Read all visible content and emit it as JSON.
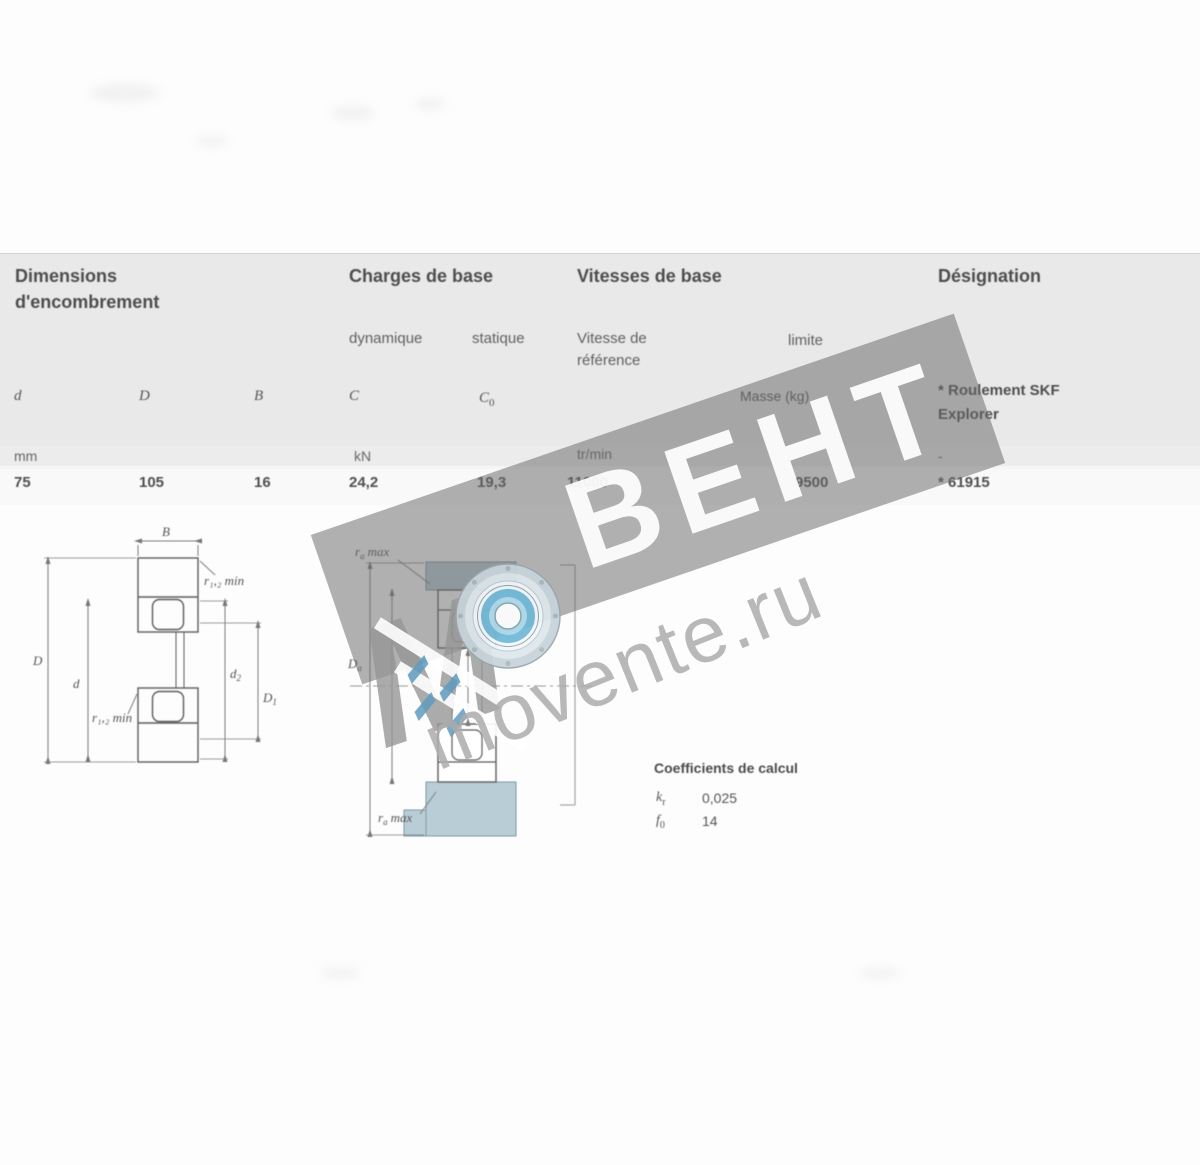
{
  "table": {
    "group1_line1": "Dimensions",
    "group1_line2": "d'encombrement",
    "group2": "Charges de base",
    "group3": "Vitesses de base",
    "group4": "Désignation",
    "sub_dyn": "dynamique",
    "sub_stat": "statique",
    "sub_ref1": "Vitesse de",
    "sub_ref2": "référence",
    "sub_lim": "limite",
    "sym_d": "d",
    "sym_D": "D",
    "sym_B": "B",
    "sym_C": "C",
    "sym_C0_base": "C",
    "sym_C0_sub": "0",
    "sym_mass": "Masse (kg)",
    "note_line1": "* Roulement SKF",
    "note_line2": "Explorer",
    "unit_dim": "mm",
    "unit_load": "kN",
    "unit_speed": "tr/min",
    "unit_desig": "-",
    "val_d": "75",
    "val_D": "105",
    "val_B": "16",
    "val_C": "24,2",
    "val_C0": "19,3",
    "val_vref": "11000",
    "val_vlim": "9500",
    "val_desig": "* 61915"
  },
  "drawings": {
    "left": {
      "B": "B",
      "r12_top": "r₁,₂ min",
      "r12_bottom": "r₁,₂ min",
      "D": "D",
      "d": "d",
      "d2_base": "d",
      "d2_sub": "2",
      "D1_base": "D",
      "D1_sub": "1"
    },
    "middle": {
      "ra_top_base": "r",
      "ra_top_sub": "a",
      "ra_top_suffix": "max",
      "ra_bot_base": "r",
      "ra_bot_sub": "a",
      "ra_bot_suffix": "max",
      "Da_base": "D",
      "Da_sub": "a",
      "da_base": "d",
      "da_sub": "a"
    },
    "calc": {
      "title": "Coefficients de calcul",
      "k_base": "k",
      "k_sub": "r",
      "k_val": "0,025",
      "f_base": "f",
      "f_sub": "0",
      "f_val": "14"
    }
  },
  "watermark": {
    "letter_m": "М",
    "text": "ВЕНТ",
    "site": "movente.ru"
  }
}
